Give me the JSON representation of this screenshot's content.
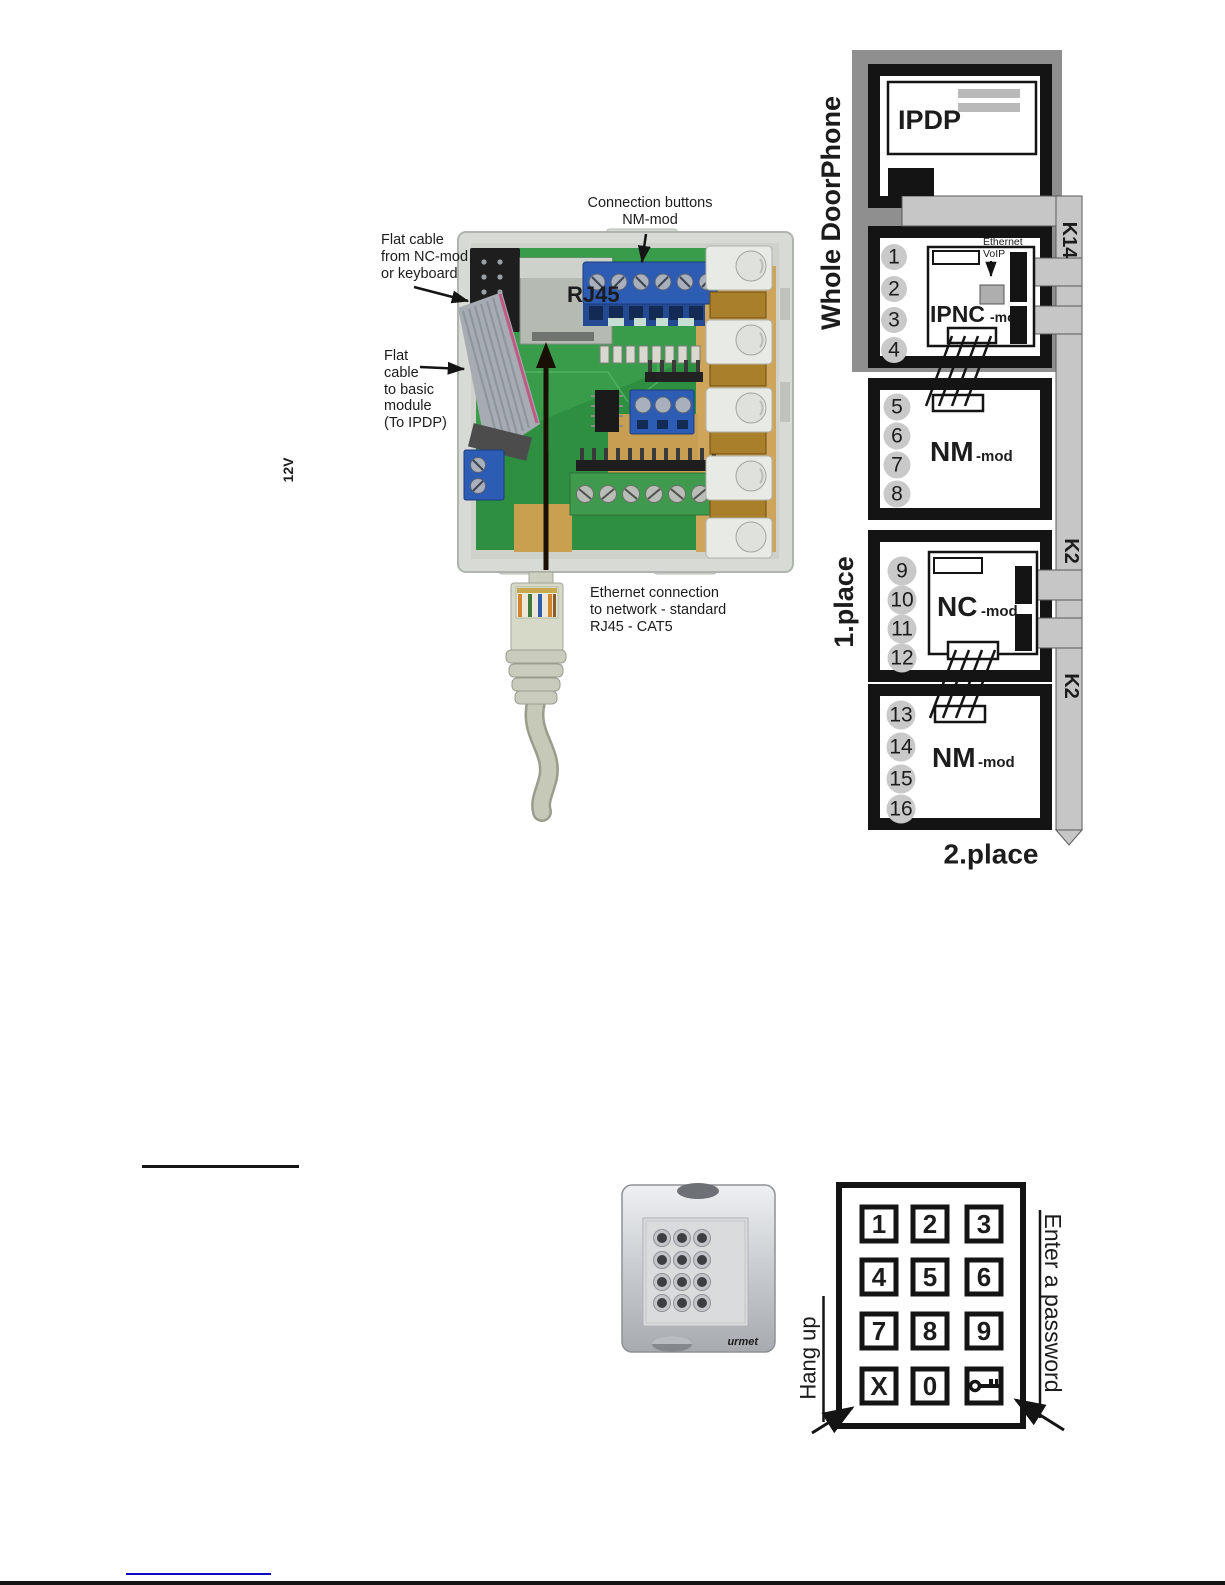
{
  "colors": {
    "diagram_black": "#1a1a1a",
    "frame_gray": "#8f8f8f",
    "cable_gray": "#c6c6c6",
    "terminal_circle_gray": "#c9c9c9",
    "pcb_green": "#2e8f41",
    "terminal_blue": "#2c5cb4",
    "kraft_tan": "#cfa55c",
    "link_blue": "#0b0bc4"
  },
  "board_photo": {
    "rj45_label": "RJ45",
    "voltage_label": "12V",
    "annotations": {
      "connection_buttons": "Connection buttons\nNM-mod",
      "flat_cable_from": "Flat cable\nfrom NC-mod\nor keyboard",
      "flat_cable_to": "Flat\ncable\nto basic\nmodule\n(To IPDP)",
      "ethernet_connection": "Ethernet connection\nto network - standard\nRJ45 - CAT5"
    }
  },
  "diagram": {
    "title_vertical": "Whole DoorPhone",
    "ipdp_label": "IPDP",
    "ethernet_label": "Ethernet",
    "voip_label": "VoIP",
    "modules": [
      {
        "name": "IPNC",
        "suffix": "-mod"
      },
      {
        "name": "NM",
        "suffix": "-mod"
      },
      {
        "name": "NC",
        "suffix": "-mod"
      },
      {
        "name": "NM",
        "suffix": "-mod"
      }
    ],
    "cable_labels": {
      "k14": "K14",
      "k2_upper": "K2",
      "k2_lower": "K2"
    },
    "place_labels": {
      "first": "1.place",
      "second": "2.place"
    },
    "terminal_numbers": [
      "1",
      "2",
      "3",
      "4",
      "5",
      "6",
      "7",
      "8",
      "9",
      "10",
      "11",
      "12",
      "13",
      "14",
      "15",
      "16"
    ]
  },
  "keypad": {
    "photo_brand": "urmet",
    "keys": [
      "1",
      "2",
      "3",
      "4",
      "5",
      "6",
      "7",
      "8",
      "9",
      "X",
      "0"
    ],
    "labels": {
      "hang_up": "Hang up",
      "enter_password": "Enter a password"
    }
  }
}
